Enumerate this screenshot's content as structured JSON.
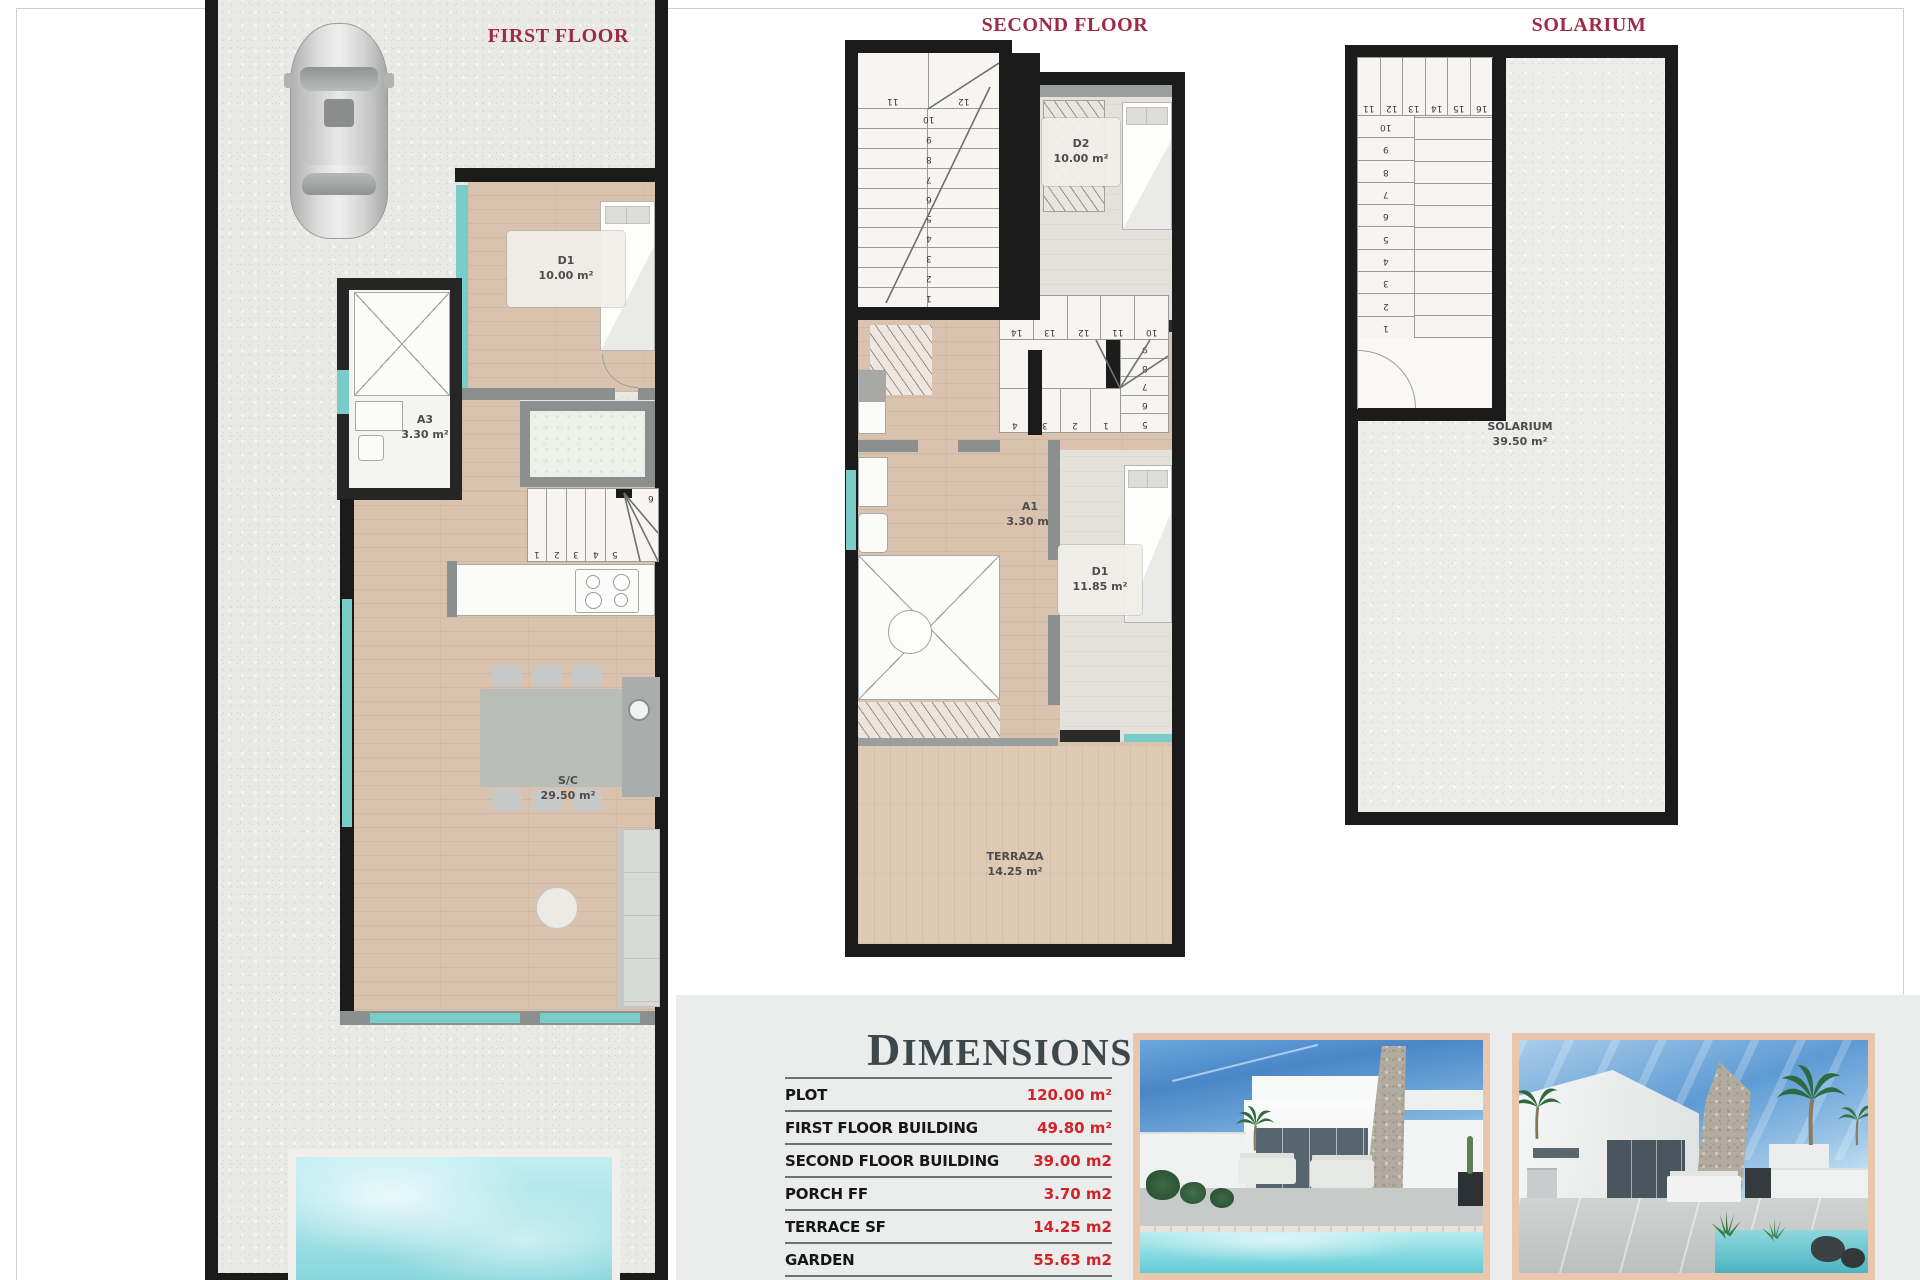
{
  "titles": {
    "first_floor": "FIRST FLOOR",
    "second_floor": "SECOND FLOOR",
    "solarium": "SOLARIUM"
  },
  "first_floor": {
    "rooms": {
      "d1": {
        "code": "D1",
        "area": "10.00 m²"
      },
      "a3": {
        "code": "A3",
        "area": "3.30 m²"
      },
      "sc": {
        "code": "S/C",
        "area": "29.50 m²"
      }
    },
    "stair_cells": [
      "1",
      "2",
      "3",
      "4",
      "5"
    ],
    "stair_corner": "6"
  },
  "second_floor": {
    "rooms": {
      "d2": {
        "code": "D2",
        "area": "10.00 m²"
      },
      "a1": {
        "code": "A1",
        "area": "3.30 m²"
      },
      "d1": {
        "code": "D1",
        "area": "11.85 m²"
      },
      "terraza": {
        "code": "TERRAZA",
        "area": "14.25 m²"
      }
    },
    "left_stair_winders": [
      "11",
      "12"
    ],
    "left_stair_column": [
      "10",
      "9",
      "8",
      "7",
      "6",
      "5",
      "4",
      "3",
      "2",
      "1"
    ],
    "mid_stair_top": [
      "14",
      "13",
      "12",
      "11",
      "10"
    ],
    "mid_stair_right": [
      "9",
      "8",
      "7",
      "6",
      "5"
    ],
    "mid_stair_bottom": [
      "4",
      "3",
      "2",
      "1"
    ]
  },
  "solarium": {
    "label": {
      "code": "SOLARIUM",
      "area": "39.50 m²"
    },
    "stair_top_row": [
      "11",
      "12",
      "13",
      "14",
      "15",
      "16"
    ],
    "stair_column": [
      "10",
      "9",
      "8",
      "7",
      "6",
      "5",
      "4",
      "3",
      "2",
      "1"
    ]
  },
  "dimensions": {
    "title": "DIMENSIONS",
    "rows": [
      {
        "label": "PLOT",
        "value": "120.00 m²"
      },
      {
        "label": "FIRST FLOOR BUILDING",
        "value": "49.80 m²"
      },
      {
        "label": "SECOND FLOOR BUILDING",
        "value": "39.00 m2"
      },
      {
        "label": "PORCH FF",
        "value": "3.70 m2"
      },
      {
        "label": "TERRACE SF",
        "value": "14.25 m2"
      },
      {
        "label": "GARDEN",
        "value": "55.63 m2"
      },
      {
        "label": "POOL",
        "value": "10.00 m2"
      }
    ]
  },
  "colors": {
    "title_red": "#9e2b45",
    "value_red": "#d22329",
    "wall_black": "#1b1b1b",
    "interior_wall_gray": "#8b8f8e",
    "window_teal": "#79ccc7",
    "wood_floor": "#d9c3ae",
    "pool_water": "#7fd4dc",
    "photo_frame": "#e9c7ad"
  }
}
